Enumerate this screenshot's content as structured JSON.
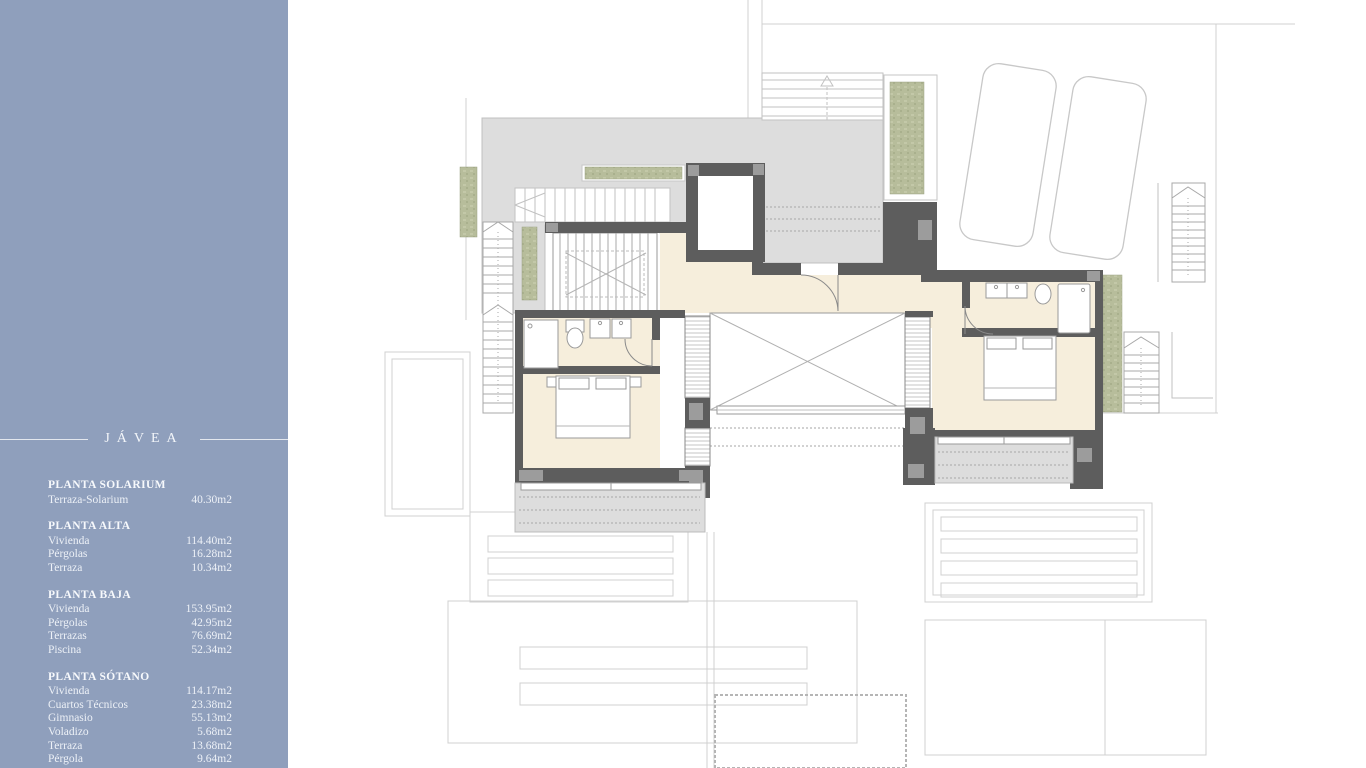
{
  "sidebar": {
    "background": "#8f9fbc",
    "title": "JÁVEA",
    "sections": [
      {
        "heading": "PLANTA SOLARIUM",
        "rows": [
          {
            "label": "Terraza-Solarium",
            "value": "40.30m2"
          }
        ]
      },
      {
        "heading": "PLANTA ALTA",
        "rows": [
          {
            "label": "Vivienda",
            "value": "114.40m2"
          },
          {
            "label": "Pérgolas",
            "value": "16.28m2"
          },
          {
            "label": "Terraza",
            "value": "10.34m2"
          }
        ]
      },
      {
        "heading": "PLANTA BAJA",
        "rows": [
          {
            "label": "Vivienda",
            "value": "153.95m2"
          },
          {
            "label": "Pérgolas",
            "value": "42.95m2"
          },
          {
            "label": "Terrazas",
            "value": "76.69m2"
          },
          {
            "label": "Piscina",
            "value": "52.34m2"
          }
        ]
      },
      {
        "heading": "PLANTA SÓTANO",
        "rows": [
          {
            "label": "Vivienda",
            "value": "114.17m2"
          },
          {
            "label": "Cuartos Técnicos",
            "value": "23.38m2"
          },
          {
            "label": "Gimnasio",
            "value": "55.13m2"
          },
          {
            "label": "Voladizo",
            "value": "5.68m2"
          },
          {
            "label": "Terraza",
            "value": "13.68m2"
          },
          {
            "label": "Pérgola",
            "value": "9.64m2"
          }
        ]
      }
    ]
  },
  "plan": {
    "colors": {
      "wall": "#5d5d5d",
      "wall_column": "#9c9c9c",
      "room_fill": "#f6eedc",
      "terrace_fill": "#dddddd",
      "vegetation": "#b7bd9b",
      "faint_line": "#d0d0d0"
    }
  }
}
